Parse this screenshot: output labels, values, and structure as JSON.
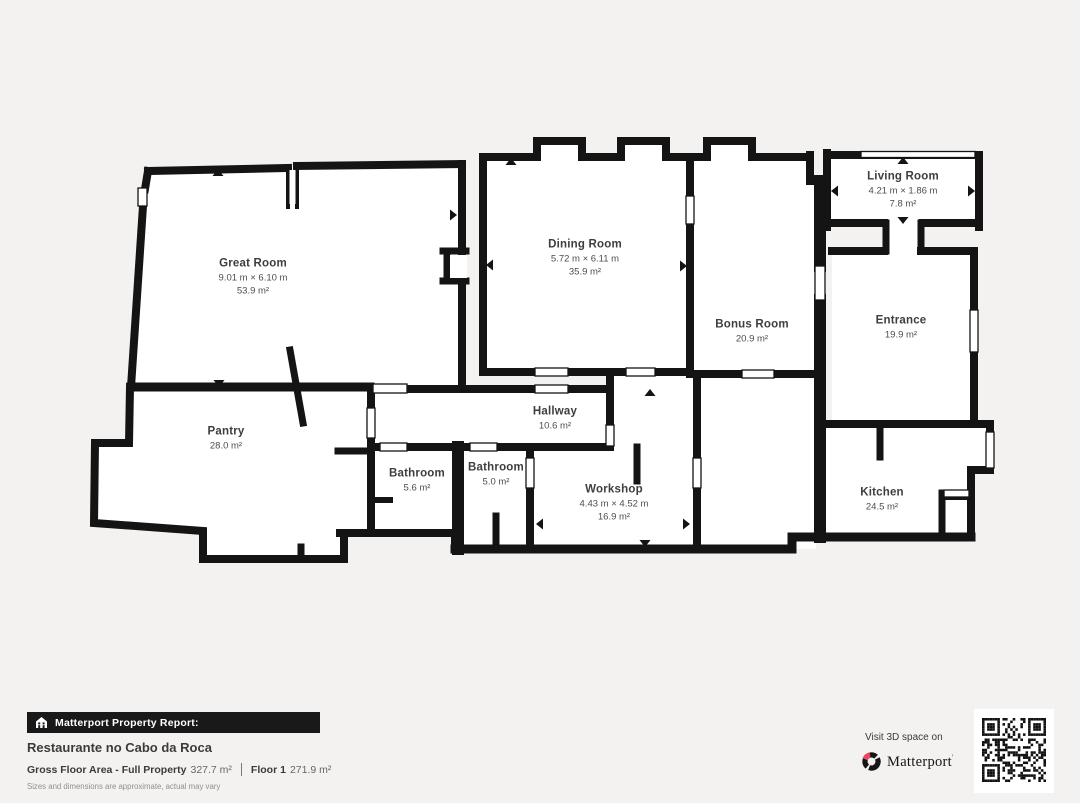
{
  "colors": {
    "background": "#f3f2f0",
    "wall": "#141414",
    "room_fill": "#ffffff",
    "brand_red": "#e8485e"
  },
  "rooms": [
    {
      "name": "Great Room",
      "dimensions": "9.01 m × 6.10 m",
      "area": "53.9 m²"
    },
    {
      "name": "Dining Room",
      "dimensions": "5.72 m × 6.11 m",
      "area": "35.9 m²"
    },
    {
      "name": "Living Room",
      "dimensions": "4.21 m × 1.86 m",
      "area": "7.8 m²"
    },
    {
      "name": "Bonus Room",
      "dimensions": "",
      "area": "20.9 m²"
    },
    {
      "name": "Entrance",
      "dimensions": "",
      "area": "19.9 m²"
    },
    {
      "name": "Pantry",
      "dimensions": "",
      "area": "28.0 m²"
    },
    {
      "name": "Hallway",
      "dimensions": "",
      "area": "10.6 m²"
    },
    {
      "name": "Bathroom",
      "dimensions": "",
      "area": "5.6 m²"
    },
    {
      "name": "Bathroom",
      "dimensions": "",
      "area": "5.0 m²"
    },
    {
      "name": "Workshop",
      "dimensions": "4.43 m × 4.52 m",
      "area": "16.9 m²"
    },
    {
      "name": "Kitchen",
      "dimensions": "",
      "area": "24.5 m²"
    }
  ],
  "footer": {
    "report_label": "Matterport Property Report:",
    "property_name": "Restaurante no Cabo da Roca",
    "gross_floor_area_label": "Gross Floor Area - Full Property",
    "gross_floor_area_value": "327.7 m²",
    "floor_label": "Floor 1",
    "floor_value": "271.9 m²",
    "disclaimer": "Sizes and dimensions are approximate, actual may vary"
  },
  "cta": {
    "visit_text": "Visit 3D space on",
    "brand": "Matterport",
    "trademark": "'"
  }
}
